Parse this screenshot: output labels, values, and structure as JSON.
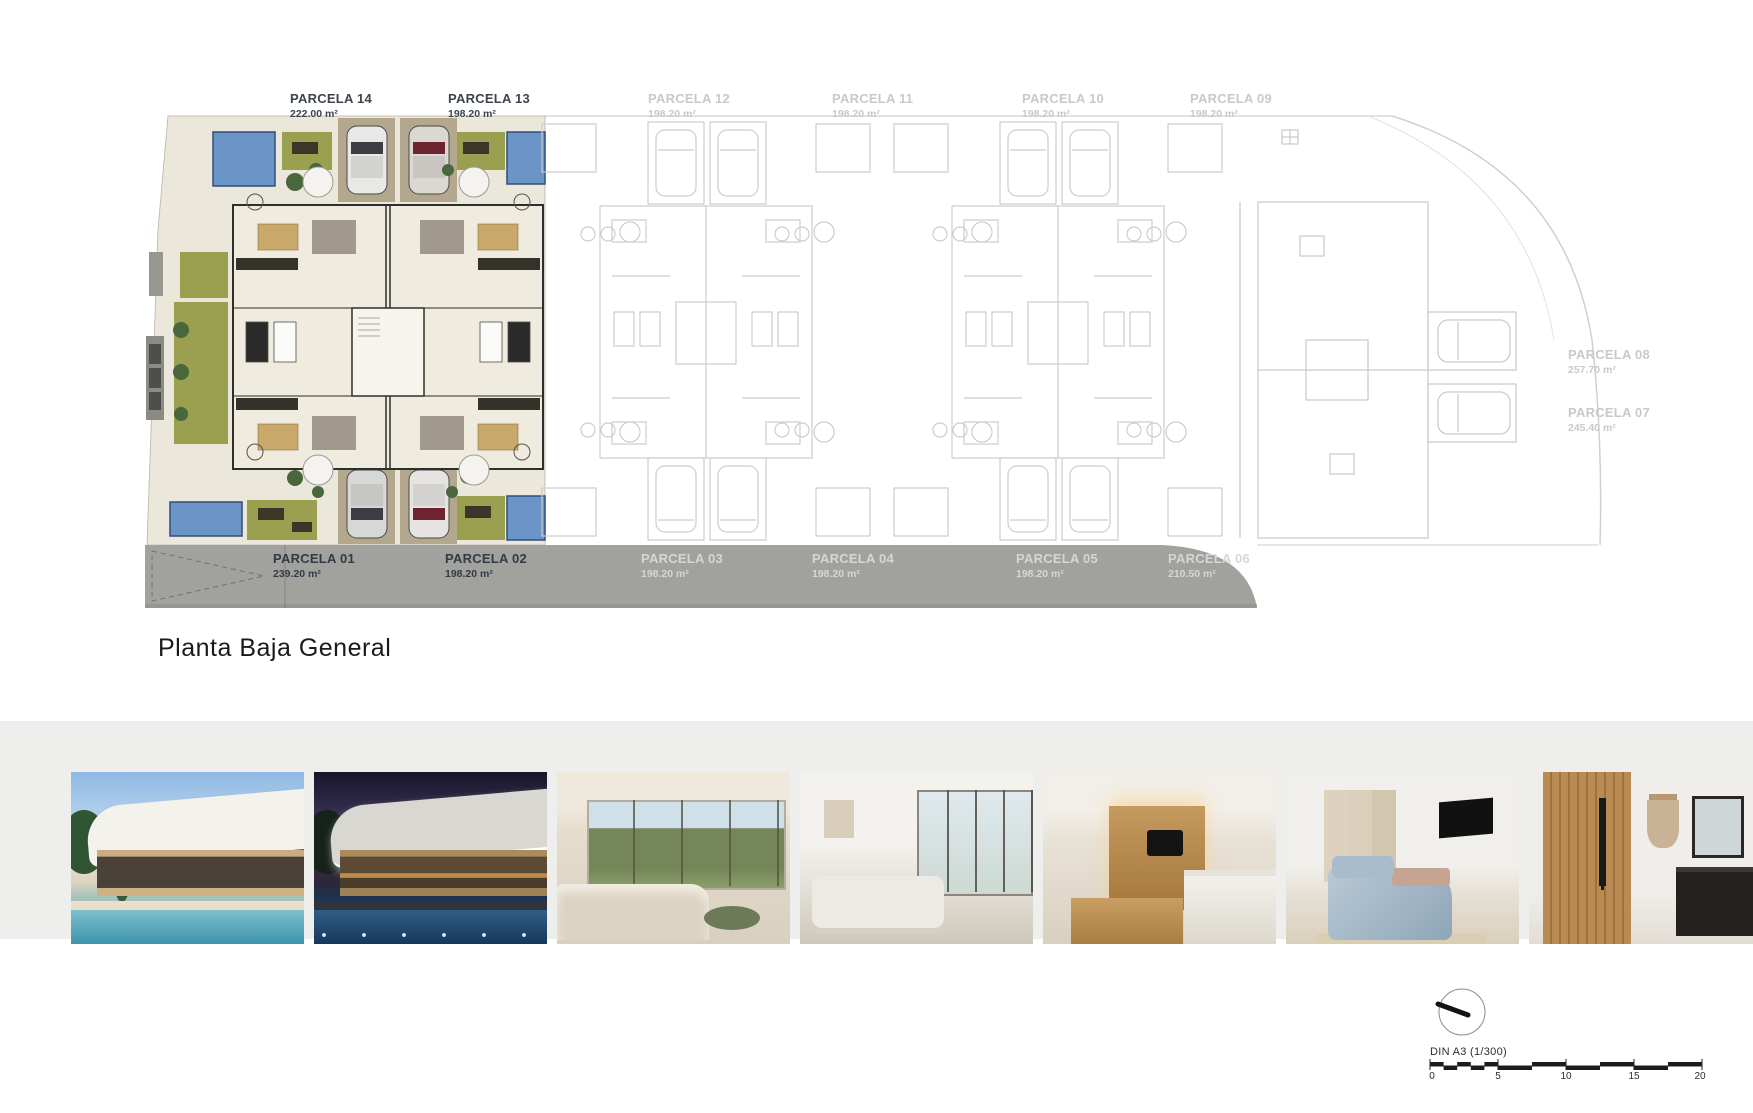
{
  "page": {
    "title": "Planta Baja General"
  },
  "plan": {
    "top_parcels": [
      {
        "name": "PARCELA 14",
        "area": "222.00 m²",
        "tone": "dark"
      },
      {
        "name": "PARCELA 13",
        "area": "198.20 m²",
        "tone": "dark"
      },
      {
        "name": "PARCELA 12",
        "area": "198.20 m²",
        "tone": "light"
      },
      {
        "name": "PARCELA 11",
        "area": "198.20 m²",
        "tone": "light"
      },
      {
        "name": "PARCELA 10",
        "area": "198.20 m²",
        "tone": "light"
      },
      {
        "name": "PARCELA 09",
        "area": "198.20 m²",
        "tone": "light"
      }
    ],
    "right_parcels": [
      {
        "name": "PARCELA 08",
        "area": "257.70 m²",
        "tone": "light"
      },
      {
        "name": "PARCELA 07",
        "area": "245.40 m²",
        "tone": "light"
      }
    ],
    "road_parcels": [
      {
        "name": "PARCELA 01",
        "area": "239.20 m²",
        "tone": "dark"
      },
      {
        "name": "PARCELA 02",
        "area": "198.20 m²",
        "tone": "dark"
      },
      {
        "name": "PARCELA 03",
        "area": "198.20 m²",
        "tone": "light"
      },
      {
        "name": "PARCELA 04",
        "area": "198.20 m²",
        "tone": "light"
      },
      {
        "name": "PARCELA 05",
        "area": "198.20 m²",
        "tone": "light"
      },
      {
        "name": "PARCELA 06",
        "area": "210.50 m²",
        "tone": "light"
      }
    ]
  },
  "scale_bar": {
    "label": "DIN A3 (1/300)",
    "ticks": [
      "0",
      "5",
      "10",
      "15",
      "20"
    ]
  },
  "gallery": {
    "photos": [
      {
        "name": "exterior-day-render"
      },
      {
        "name": "exterior-night-render"
      },
      {
        "name": "living-room-garden-render"
      },
      {
        "name": "white-living-room-render"
      },
      {
        "name": "kitchen-dining-render"
      },
      {
        "name": "bedroom-render"
      },
      {
        "name": "bathroom-render"
      }
    ]
  },
  "colors": {
    "pool": "#6b95c7",
    "grass": "#9aa050",
    "driveway": "#b3a88e",
    "floor": "#ece7db",
    "road": "#a1a19e",
    "label_dark": "#3d444d",
    "label_light": "#c9c9c6",
    "gallery_band": "#eeeeec"
  }
}
